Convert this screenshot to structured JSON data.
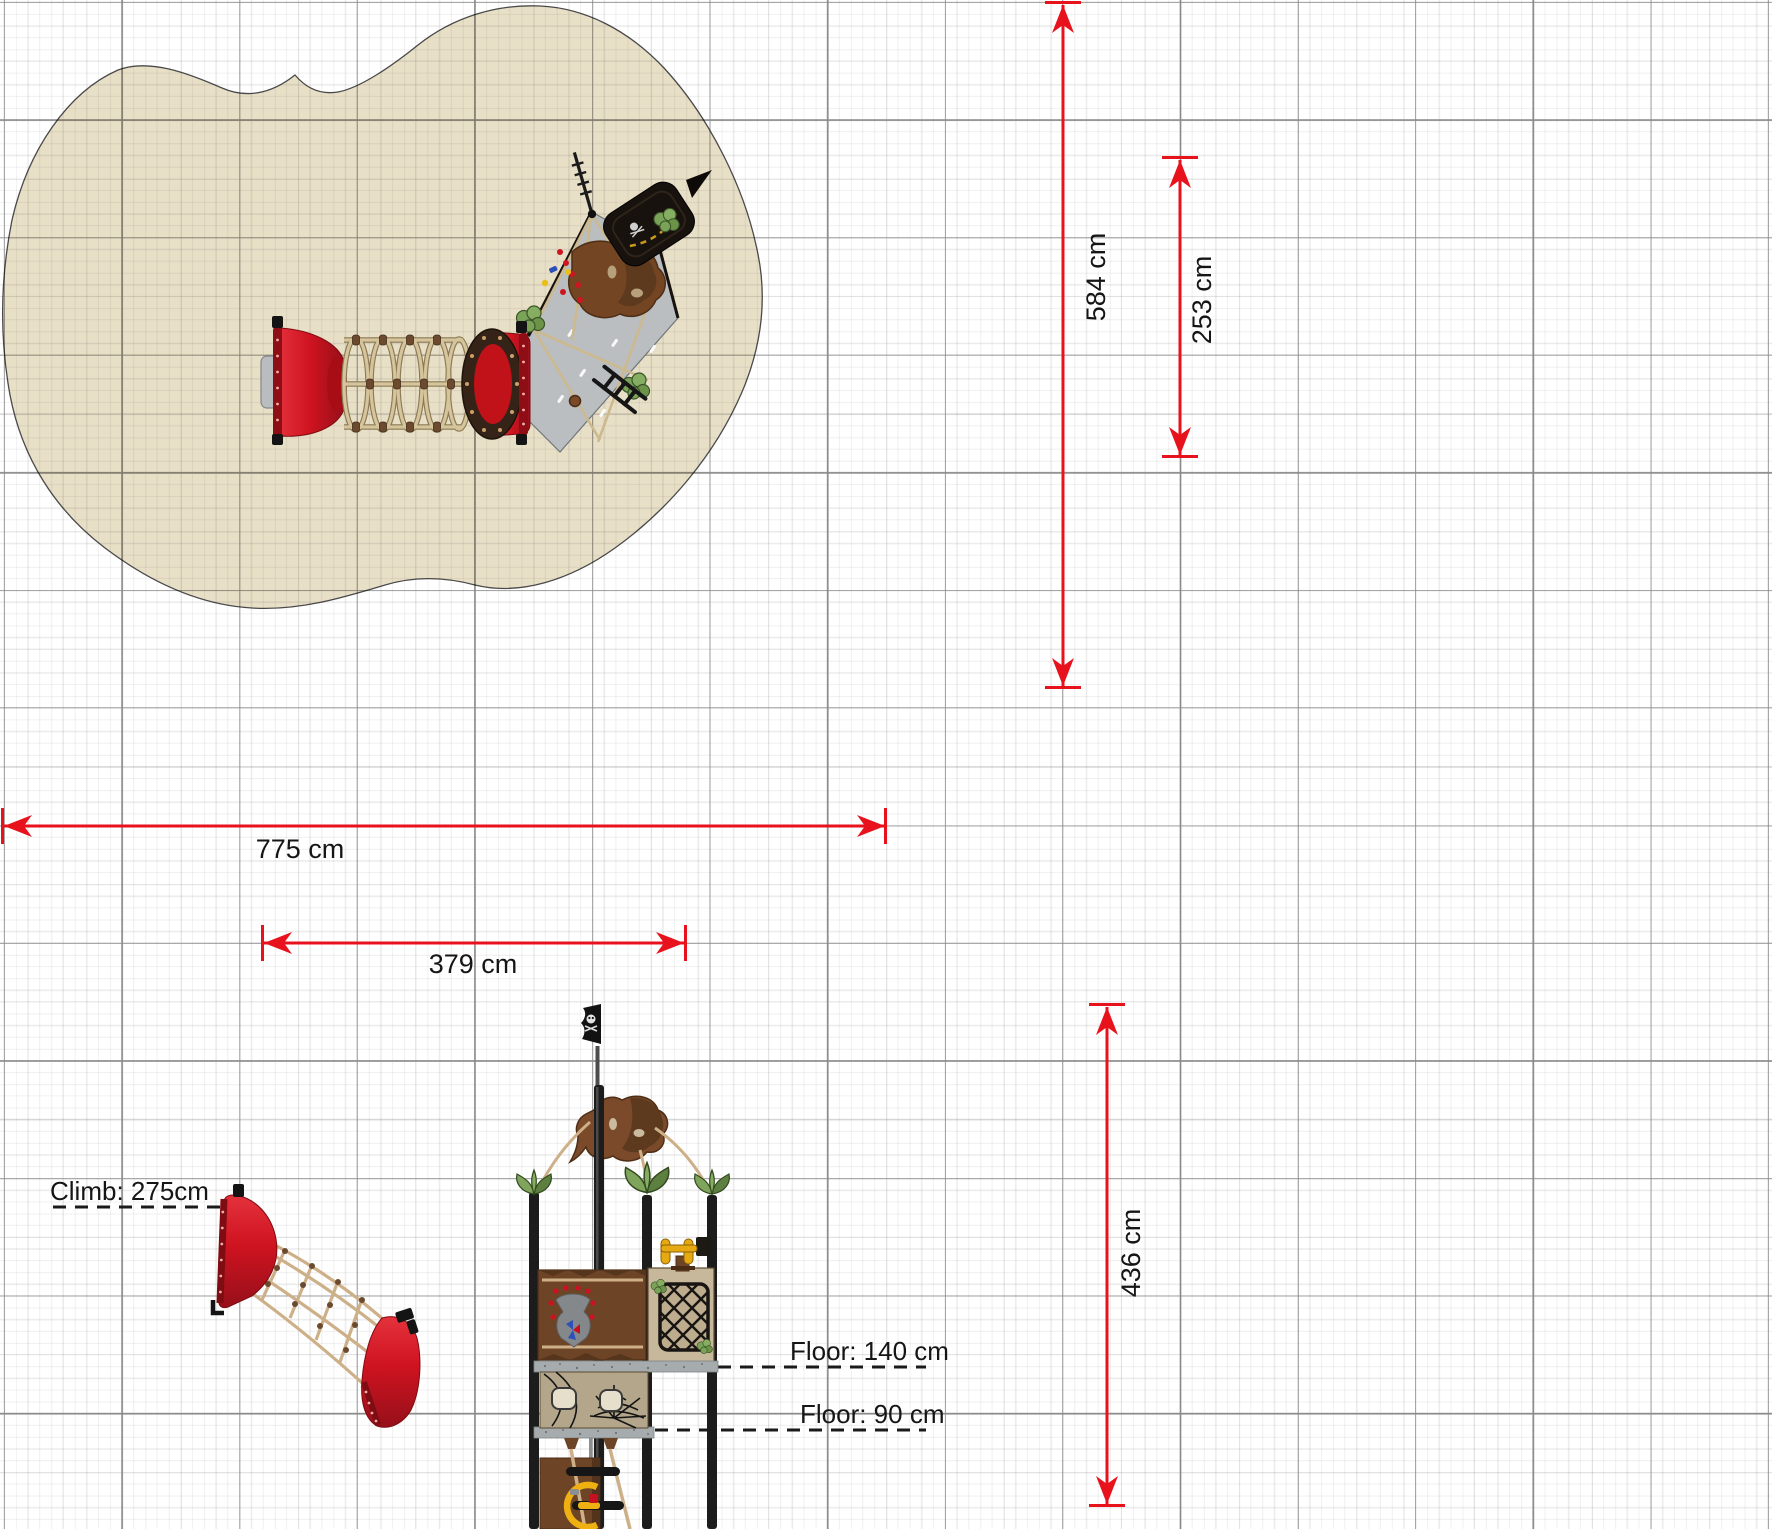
{
  "dimensions": {
    "area_width": "775 cm",
    "equipment_width": "379 cm",
    "area_depth": "584 cm",
    "equipment_depth": "253 cm",
    "total_height": "436 cm",
    "climb_height": "Climb: 275cm",
    "floor_upper": "Floor: 140 cm",
    "floor_lower": "Floor: 90 cm"
  },
  "colors": {
    "dimension_red": "#e8121c",
    "surface_beige": "#e8dfc7",
    "grid_major": "#8a8a8a",
    "equipment_red": "#cf1320",
    "equipment_red_dark": "#8f0d15",
    "rope_tan": "#cdb088",
    "wood_brown": "#6e4426",
    "platform_gray": "#babec0",
    "leaf_green": "#79a356",
    "post_black": "#1c1c1c",
    "floor_gray": "#a6abad",
    "wheel_yellow": "#efb011",
    "periscope_yellow": "#e7a912"
  },
  "icons": {
    "flag_top_view": "pirate-flag-icon",
    "flag_side_view": "skull-flag-icon",
    "web_panel": "spider-web-icon"
  }
}
